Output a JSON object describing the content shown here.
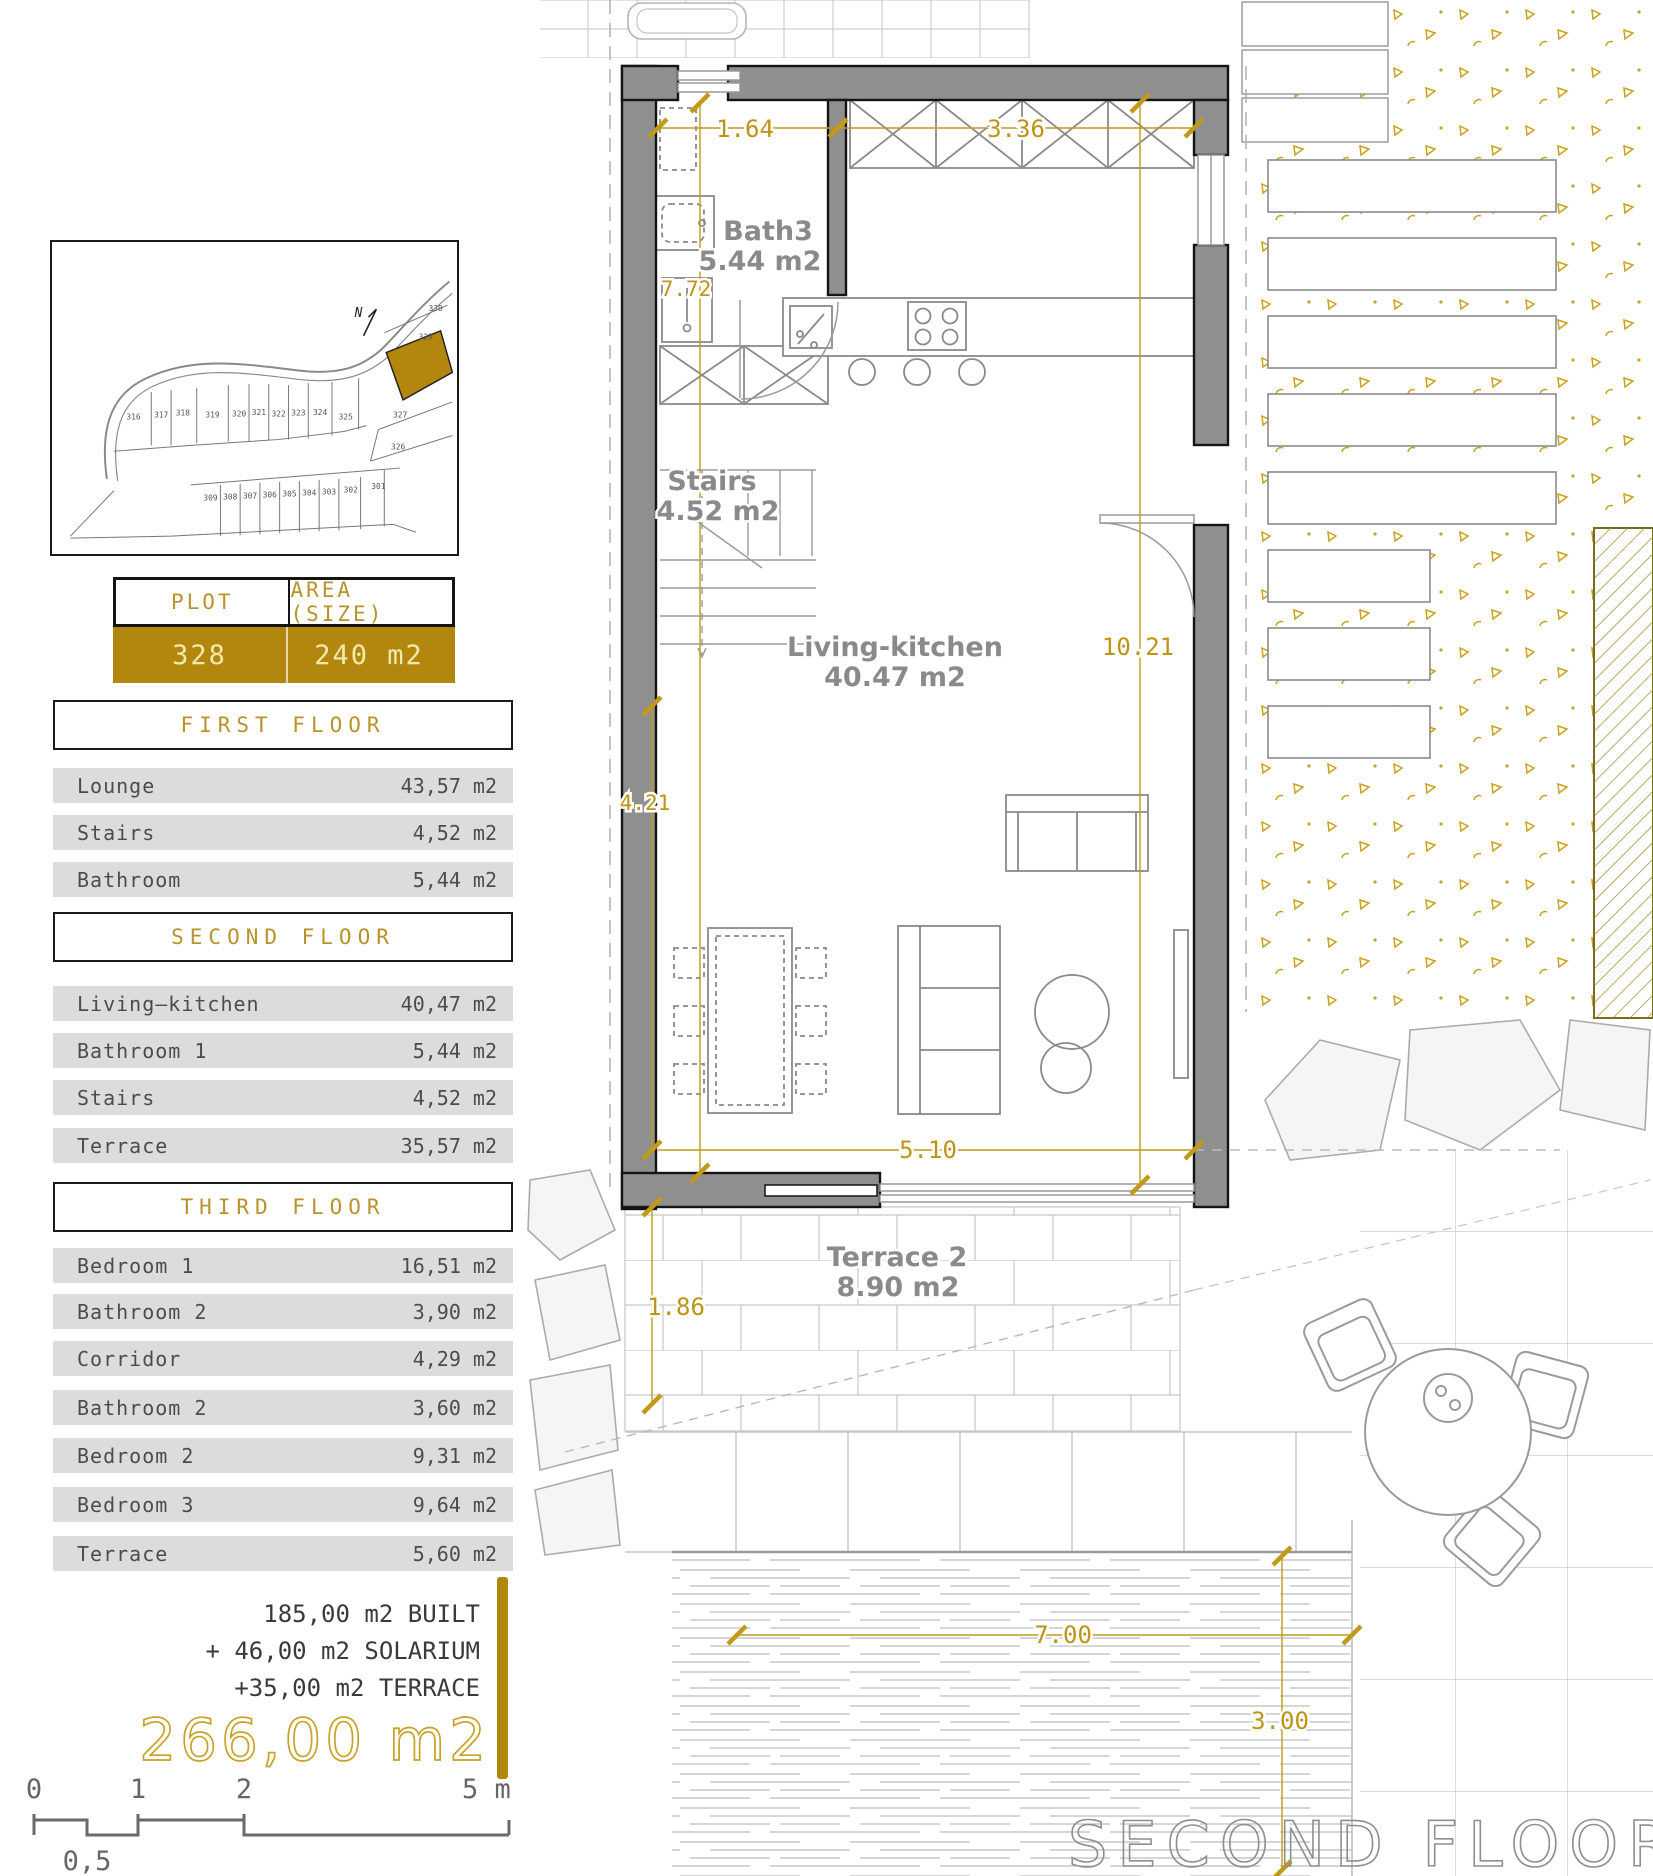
{
  "site_plan": {
    "row1": [
      "316",
      "317",
      "318",
      "319",
      "320",
      "321",
      "322",
      "323",
      "324",
      "325"
    ],
    "row2": [
      "309",
      "308",
      "307",
      "306",
      "305",
      "304",
      "303",
      "302",
      "301"
    ],
    "right": [
      "330",
      "329",
      "327",
      "326"
    ],
    "highlighted_plot": "328",
    "north_label": "N"
  },
  "plot_table": {
    "plot_header": "PLOT",
    "area_header": "AREA (SIZE)",
    "plot_value": "328",
    "area_value": "240 m2"
  },
  "floors": [
    {
      "title": "FIRST FLOOR",
      "rows": [
        {
          "label": "Lounge",
          "value": "43,57 m2"
        },
        {
          "label": "Stairs",
          "value": "4,52 m2"
        },
        {
          "label": "Bathroom",
          "value": "5,44 m2"
        }
      ]
    },
    {
      "title": "SECOND FLOOR",
      "rows": [
        {
          "label": "Living–kitchen",
          "value": "40,47 m2"
        },
        {
          "label": "Bathroom 1",
          "value": "5,44 m2"
        },
        {
          "label": "Stairs",
          "value": "4,52 m2"
        },
        {
          "label": "Terrace",
          "value": "35,57 m2"
        }
      ]
    },
    {
      "title": "THIRD FLOOR",
      "rows": [
        {
          "label": "Bedroom 1",
          "value": "16,51 m2"
        },
        {
          "label": "Bathroom 2",
          "value": "3,90 m2"
        },
        {
          "label": "Corridor",
          "value": "4,29 m2"
        },
        {
          "label": "Bathroom 2",
          "value": "3,60 m2"
        },
        {
          "label": "Bedroom 2",
          "value": "9,31 m2"
        },
        {
          "label": "Bedroom 3",
          "value": "9,64 m2"
        },
        {
          "label": "Terrace",
          "value": "5,60 m2"
        }
      ]
    }
  ],
  "totals": {
    "line1": "185,00 m2 BUILT",
    "line2": "+ 46,00 m2 SOLARIUM",
    "line3": "+35,00 m2 TERRACE",
    "total": "266,00 m2"
  },
  "scale_bar": {
    "ticks": [
      "0",
      "1",
      "2"
    ],
    "end_label": "5 m",
    "half_label": "0,5"
  },
  "plan": {
    "title": "SECOND FLOOR",
    "rooms": {
      "bath": {
        "name": "Bath3",
        "area": "5.44 m2"
      },
      "stairs": {
        "name": "Stairs",
        "area": "4.52 m2"
      },
      "living": {
        "name": "Living-kitchen",
        "area": "40.47 m2"
      },
      "terrace": {
        "name": "Terrace 2",
        "area": "8.90 m2"
      }
    },
    "dimensions": {
      "top_left": "1.64",
      "top_right": "3.36",
      "bath_height": "7.72",
      "interior_height": "10.21",
      "wall_left": "4.21",
      "bottom_width": "5.10",
      "terrace_depth": "1.86",
      "deck_width": "7.00",
      "deck_depth": "3.00"
    }
  },
  "colors": {
    "gold": "#b3870e",
    "gold_text_light": "#f2e9ad",
    "dim_gold": "#c09a18",
    "wall_gray": "#8f8f8f",
    "row_gray": "#dcdcdc"
  }
}
